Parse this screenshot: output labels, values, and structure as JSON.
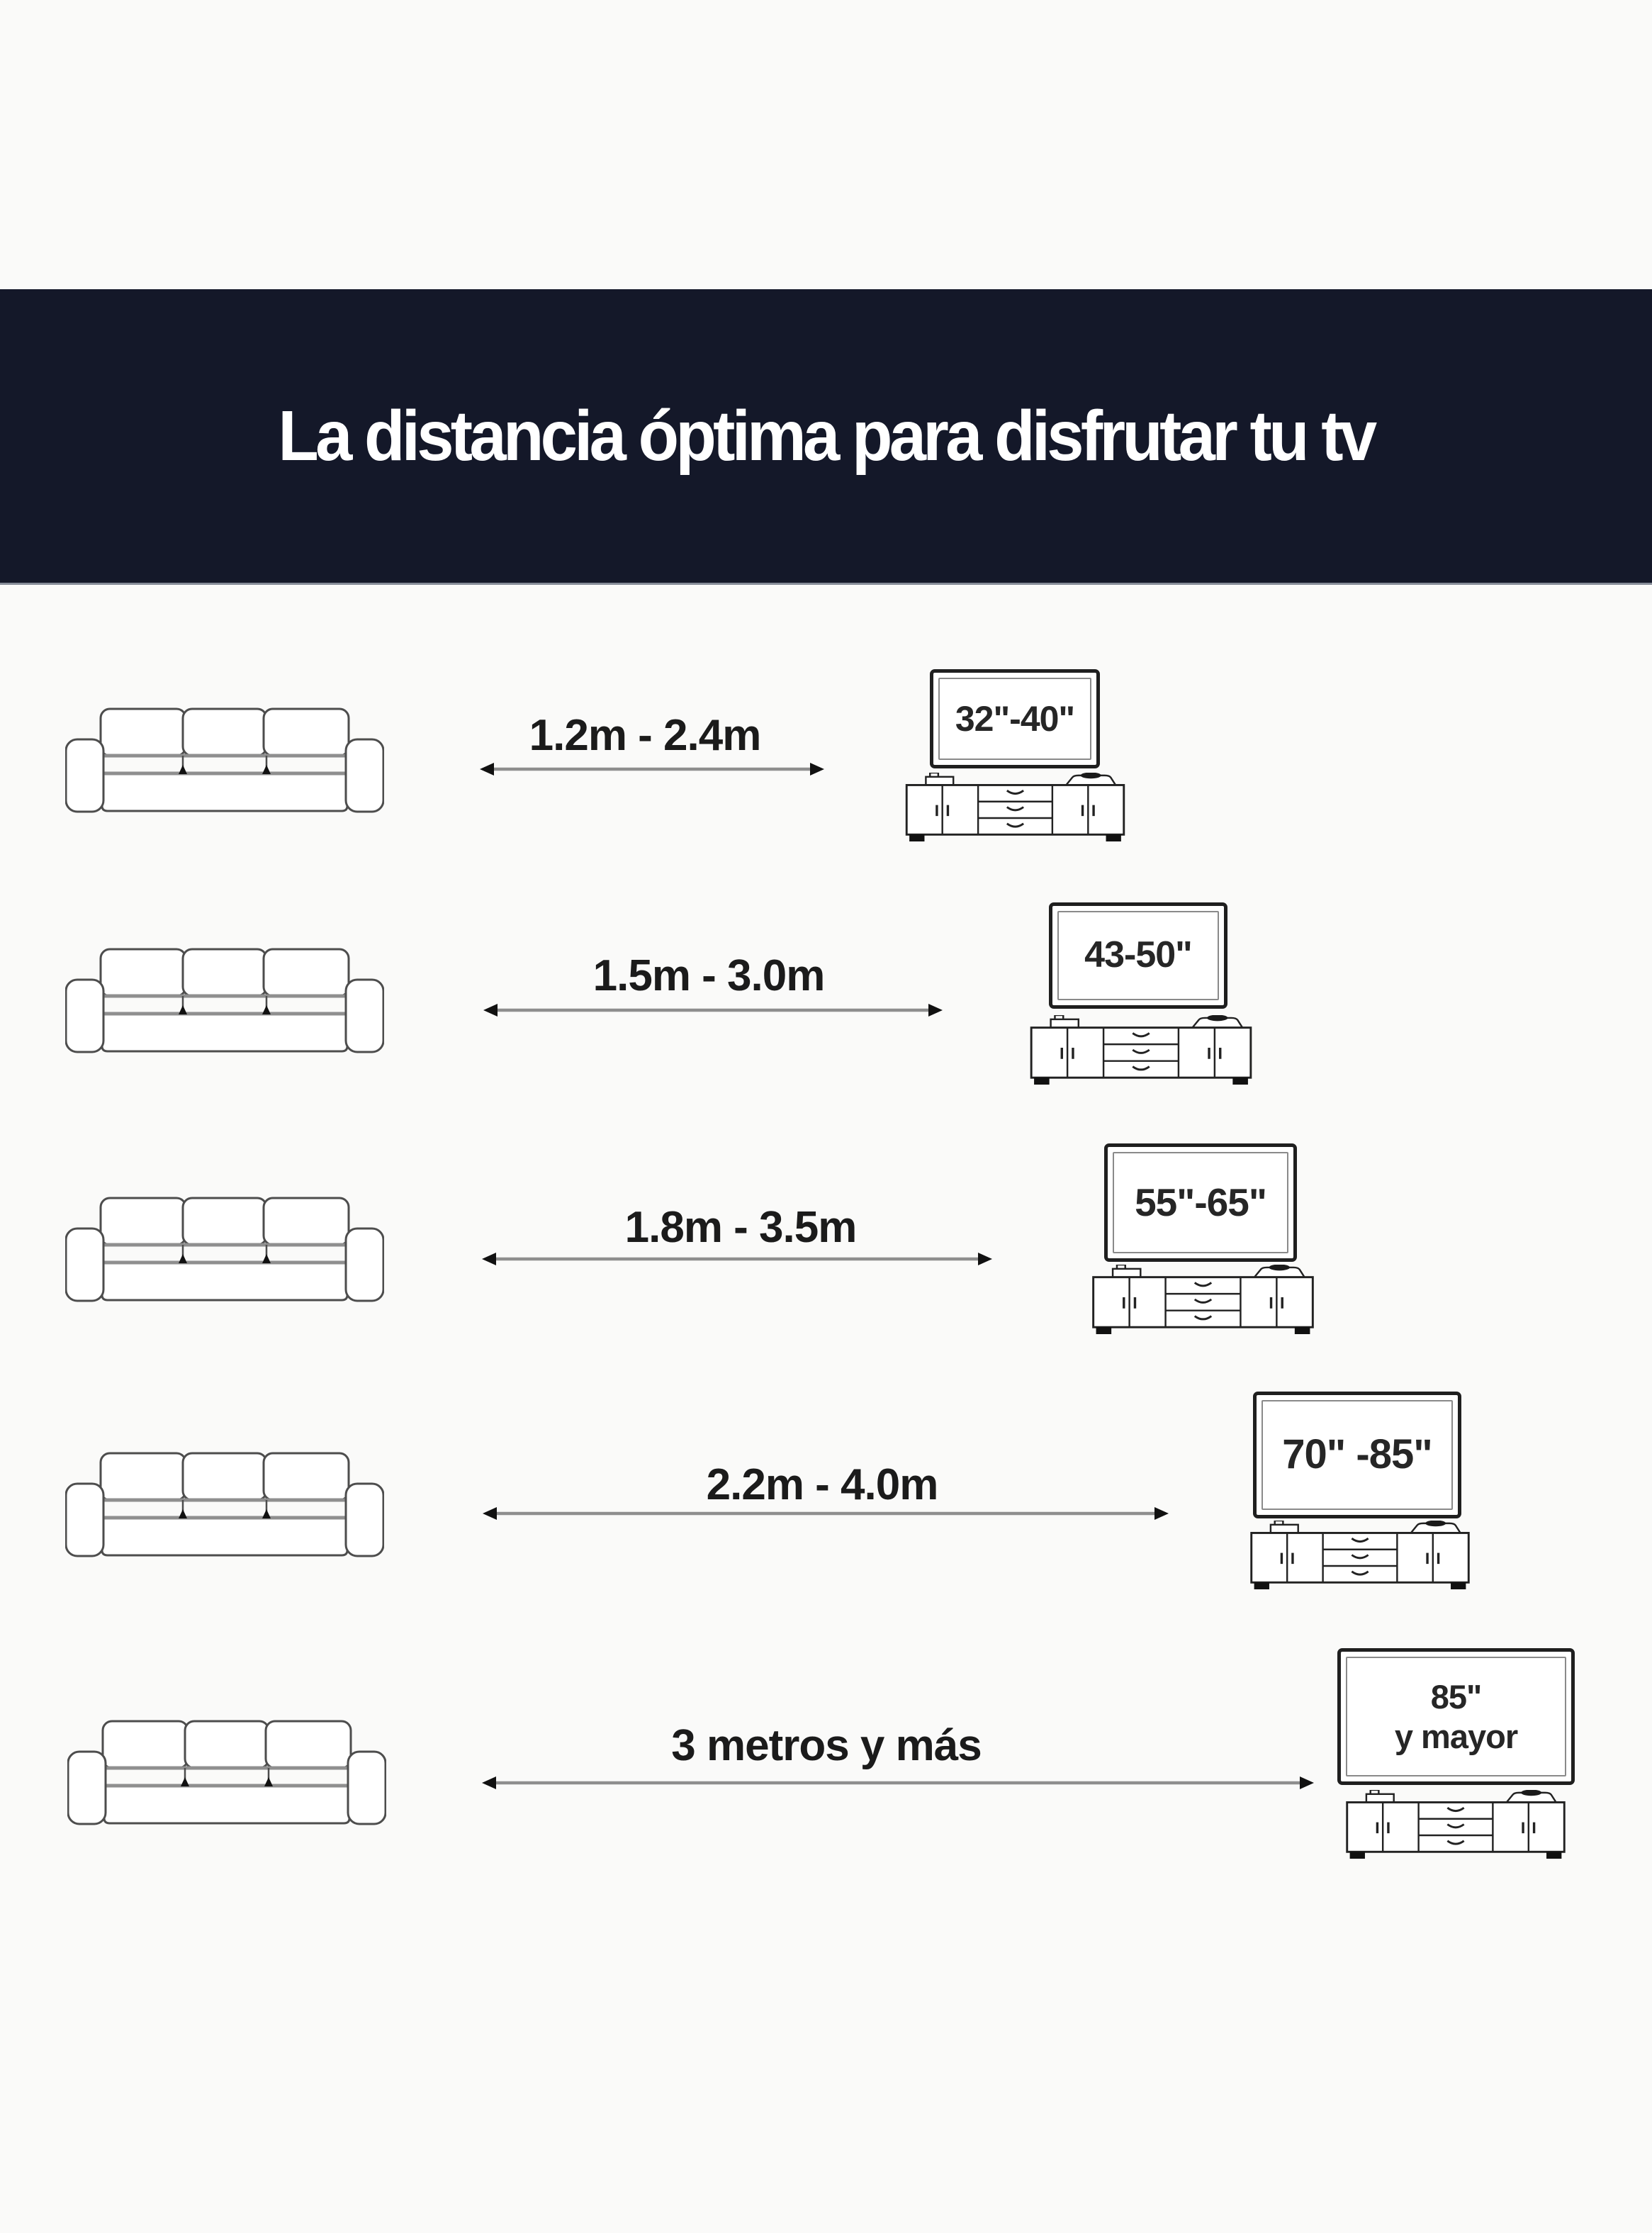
{
  "header": {
    "title": "La distancia óptima para disfrutar tu tv",
    "background_color": "#141829",
    "text_color": "#ffffff"
  },
  "rows": [
    {
      "distance": "1.2m - 2.4m",
      "tv_size": "32\"-40\""
    },
    {
      "distance": "1.5m - 3.0m",
      "tv_size": "43-50\""
    },
    {
      "distance": "1.8m - 3.5m",
      "tv_size": "55\"-65\""
    },
    {
      "distance": "2.2m - 4.0m",
      "tv_size": "70\" -85\""
    },
    {
      "distance": "3 metros y más",
      "tv_size": "85\"\ny mayor"
    }
  ],
  "icons": {
    "sofa": "sofa-icon",
    "double_arrow": "double-arrow-icon",
    "tv": "tv-screen",
    "tv_stand": "tv-stand-icon"
  },
  "colors": {
    "page_background": "#fafaf9",
    "line_art_stroke": "#4d4d4d",
    "arrow_line": "#8e8e8e",
    "arrow_head": "#111111",
    "label_text": "#1b1b1b"
  }
}
